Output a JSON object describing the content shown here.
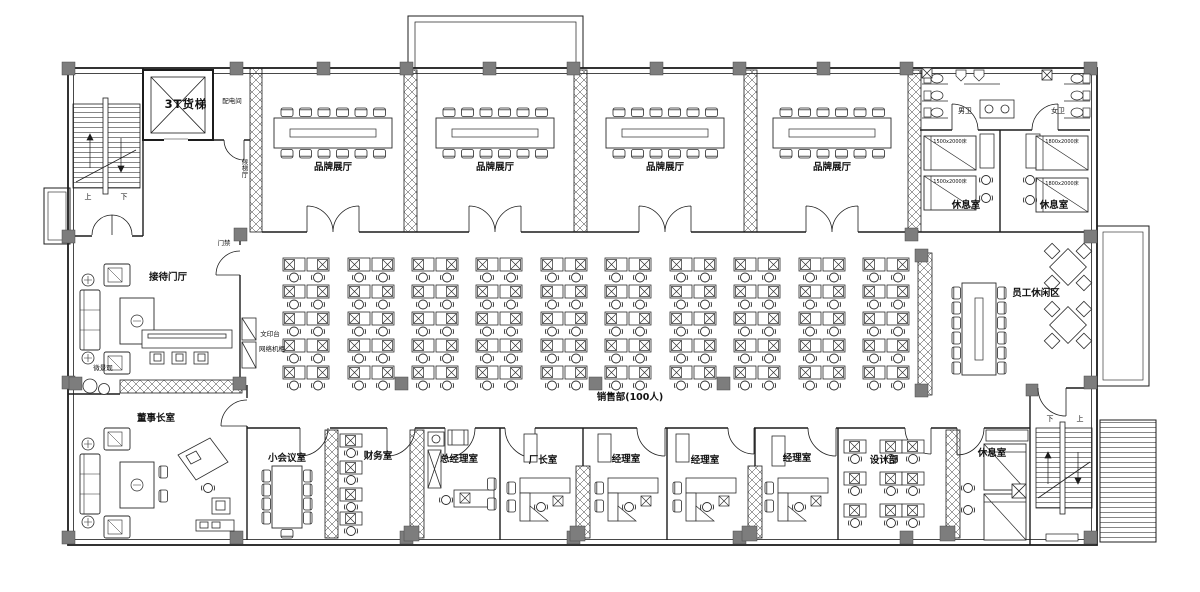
{
  "plan": {
    "background": "#ffffff",
    "line_color": "#1c1c1c",
    "column_color": "#7d7d7d",
    "hatch_color": "#3a3a3a"
  },
  "rooms": {
    "freight_elevator": "3T货梯",
    "power_room": "配电间",
    "elevator_lobby": "候梯厅",
    "showroom": "品牌展厅",
    "mens_wc": "男卫",
    "womens_wc": "女卫",
    "rest_room": "休息室",
    "reception_hall": "接待门厅",
    "sales_dept": "销售部(100人)",
    "leisure_area": "员工休闲区",
    "chairman_office": "董事长室",
    "small_meeting": "小会议室",
    "finance_office": "财务室",
    "gm_office": "总经理室",
    "factory_director": "厂长室",
    "manager_office": "经理室",
    "design_dept": "设计部"
  },
  "annotations": {
    "stair_up": "上",
    "stair_down": "下",
    "access_control": "门禁",
    "micro_landscape": "微景观",
    "print_station": "文印台",
    "network_cabinet": "网络机柜",
    "bed_1500": "1500x2000床",
    "bed_1800": "1800x2000床"
  }
}
